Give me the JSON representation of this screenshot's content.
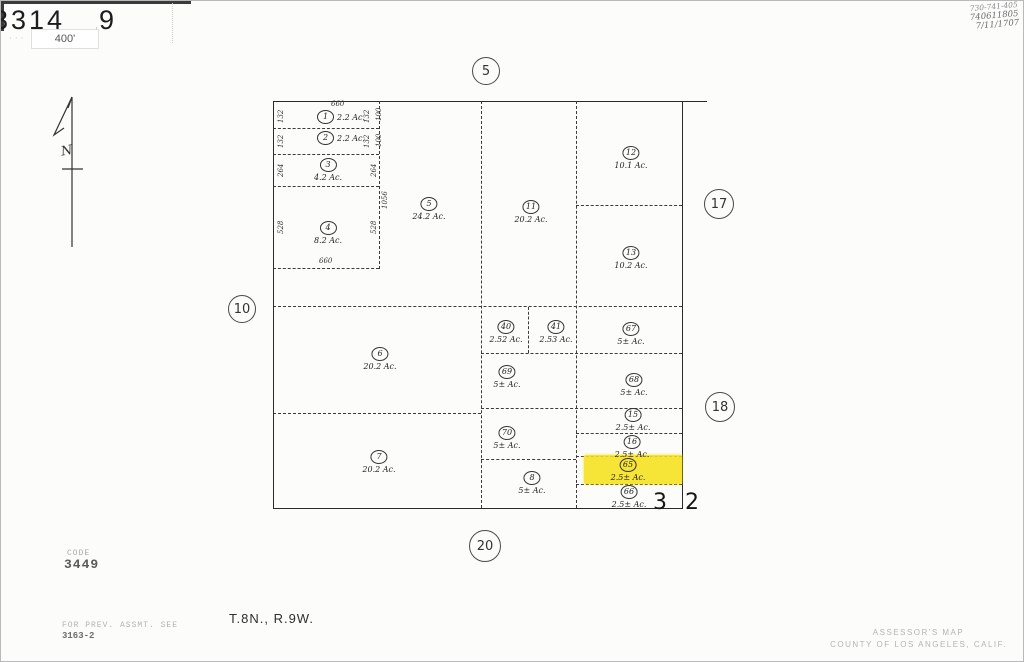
{
  "header": {
    "sheet": "3314",
    "page": "9",
    "scale_label": "400'",
    "faint_marks": "· ·  ·"
  },
  "handwritten_notes": {
    "line1": "730-741-405",
    "line2": "740611805",
    "line3": "7/11/1707"
  },
  "compass": {
    "label": "N"
  },
  "map": {
    "edge_labels": [
      {
        "label": "5"
      },
      {
        "label": "10"
      },
      {
        "label": "17"
      },
      {
        "label": "18"
      },
      {
        "label": "20"
      }
    ],
    "section_split": {
      "left": "3",
      "right": "2"
    },
    "dims": {
      "d660_top": "660",
      "d660_bot": "660",
      "l1": "132",
      "l2": "132",
      "l3": "264",
      "l4": "528",
      "r1": "132",
      "r2": "132",
      "r3": "264",
      "r4": "528",
      "s1": "100",
      "s2": "100",
      "v1056": "1056"
    },
    "parcels": [
      {
        "number": "1",
        "acreage": "2.2 Ac."
      },
      {
        "number": "2",
        "acreage": "2.2 Ac."
      },
      {
        "number": "3",
        "acreage": "4.2 Ac."
      },
      {
        "number": "4",
        "acreage": "8.2 Ac."
      },
      {
        "number": "5",
        "acreage": "24.2 Ac."
      },
      {
        "number": "11",
        "acreage": "20.2 Ac."
      },
      {
        "number": "12",
        "acreage": "10.1 Ac."
      },
      {
        "number": "13",
        "acreage": "10.2 Ac."
      },
      {
        "number": "6",
        "acreage": "20.2 Ac."
      },
      {
        "number": "7",
        "acreage": "20.2 Ac."
      },
      {
        "number": "40",
        "acreage": "2.52 Ac."
      },
      {
        "number": "41",
        "acreage": "2.53 Ac."
      },
      {
        "number": "67",
        "acreage": "5± Ac."
      },
      {
        "number": "69",
        "acreage": "5± Ac."
      },
      {
        "number": "68",
        "acreage": "5± Ac."
      },
      {
        "number": "70",
        "acreage": "5± Ac."
      },
      {
        "number": "15",
        "acreage": "2.5± Ac."
      },
      {
        "number": "16",
        "acreage": "2.5± Ac."
      },
      {
        "number": "65",
        "acreage": "2.5± Ac."
      },
      {
        "number": "8",
        "acreage": "5± Ac."
      },
      {
        "number": "66",
        "acreage": "2.5± Ac."
      }
    ],
    "highlight_color": "#f6e11c"
  },
  "footer": {
    "code_label": "CODE",
    "code_value": "3449",
    "prev_label": "FOR PREV. ASSMT. SEE",
    "prev_value": "3163-2",
    "township": "T.8N., R.9W.",
    "assessor_line1": "ASSESSOR'S MAP",
    "assessor_line2": "COUNTY OF LOS ANGELES, CALIF."
  }
}
